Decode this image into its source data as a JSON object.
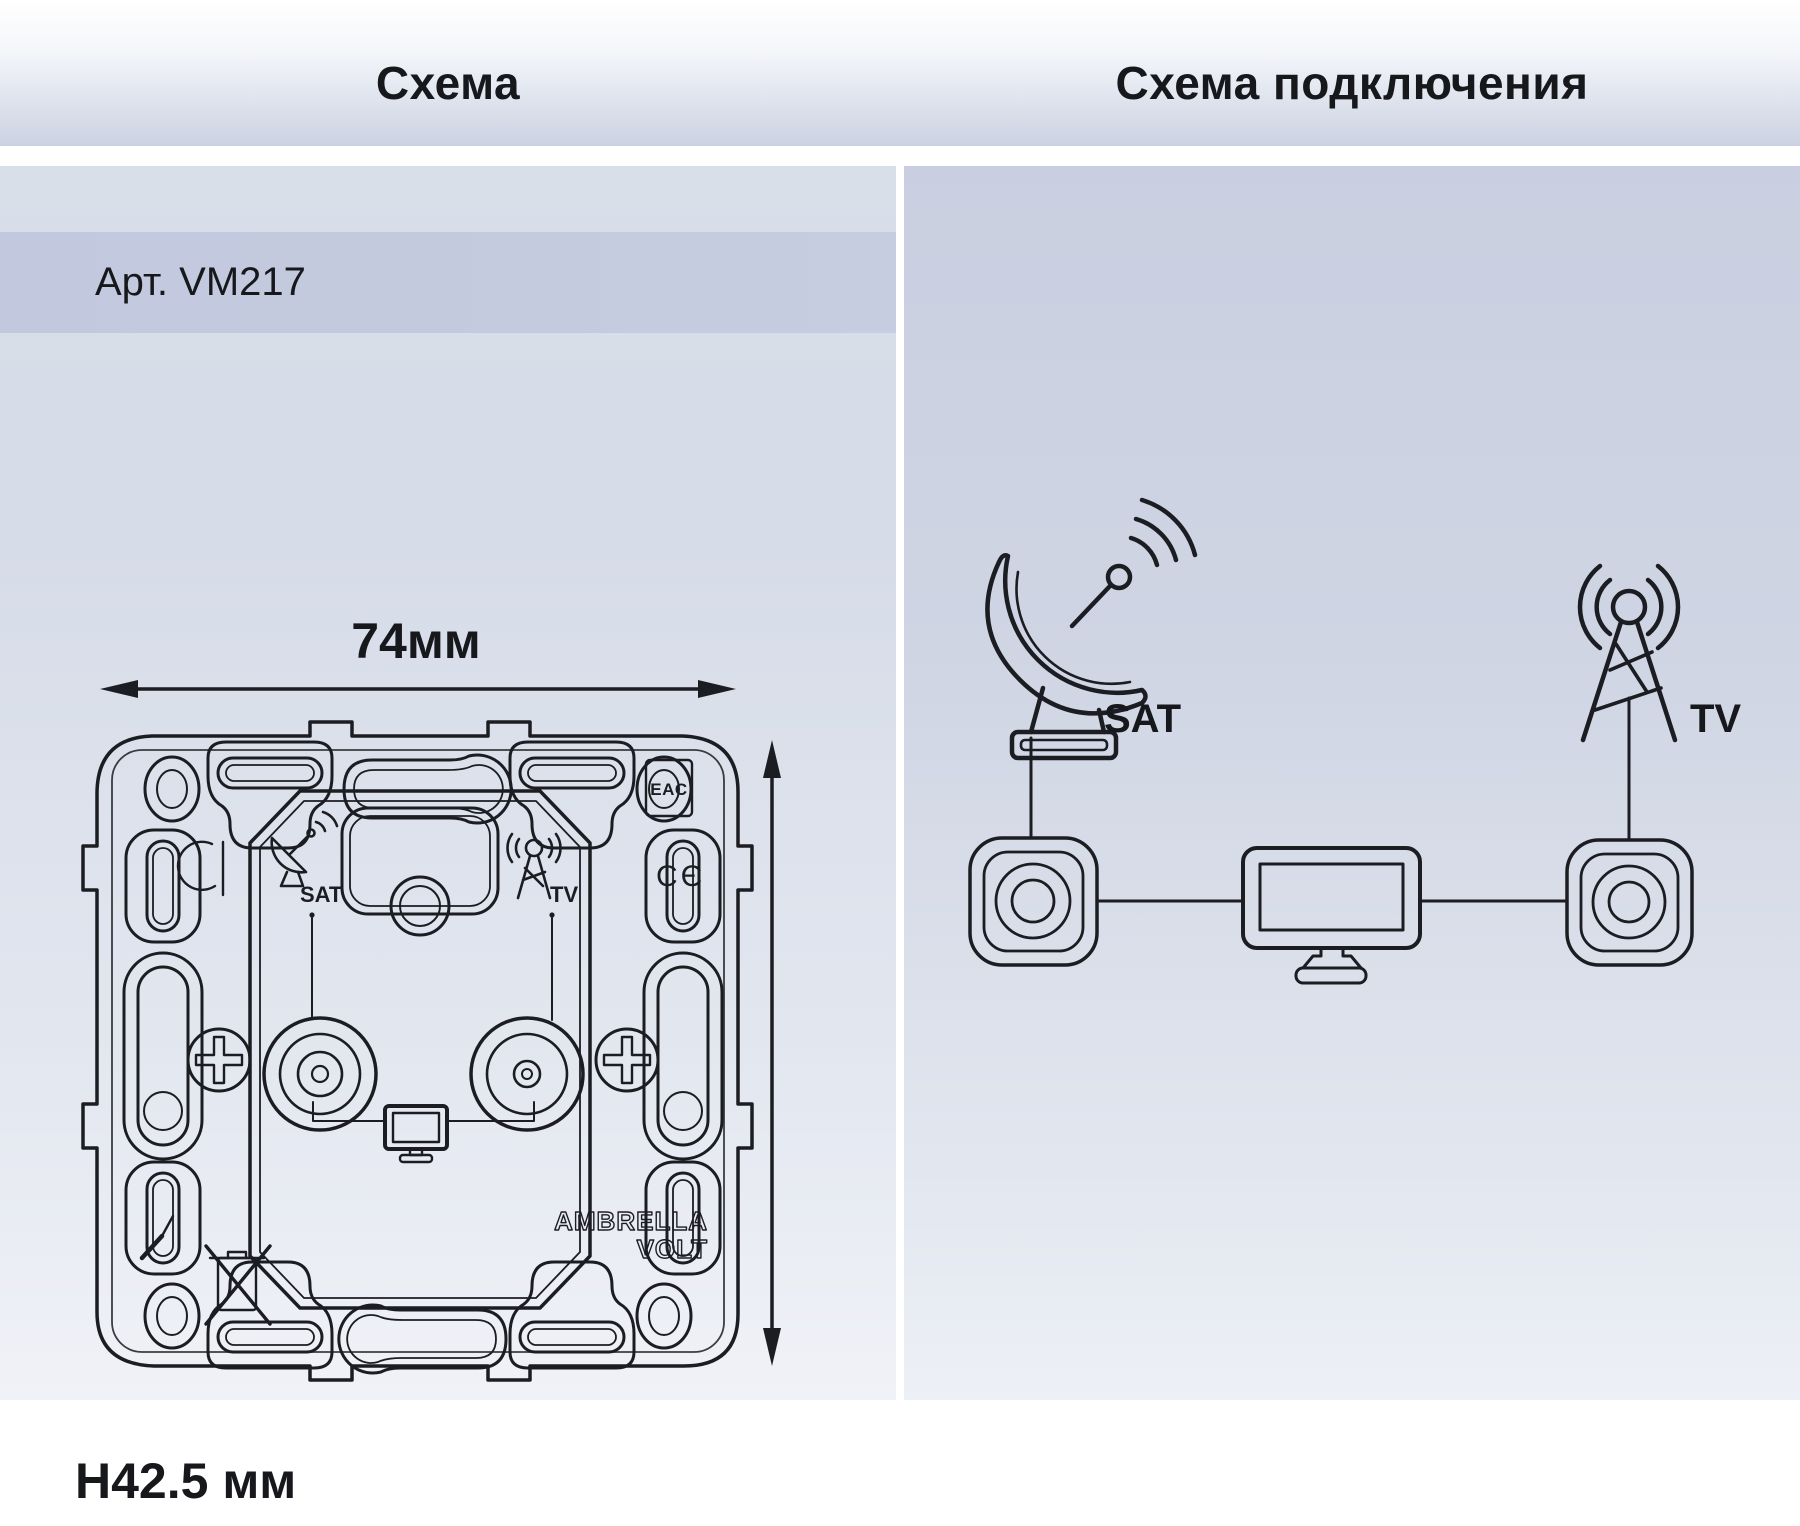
{
  "header": {
    "left_title": "Схема",
    "right_title": "Схема подключения"
  },
  "left_panel": {
    "article": "Арт. VM217",
    "dimensions": {
      "width": "74мм",
      "height": "74мм",
      "depth": "H42.5 мм"
    },
    "plate": {
      "sat_label": "SAT",
      "tv_label": "TV"
    },
    "marks": {
      "eac": "EAC",
      "ce": "CЄ"
    },
    "brand": {
      "line1": "AMBRELLA",
      "line2": "VOLT"
    }
  },
  "right_panel": {
    "sat_label": "SAT",
    "tv_label": "TV"
  },
  "colors": {
    "line": "#1c1d22",
    "article_band": "#c3c9de"
  }
}
